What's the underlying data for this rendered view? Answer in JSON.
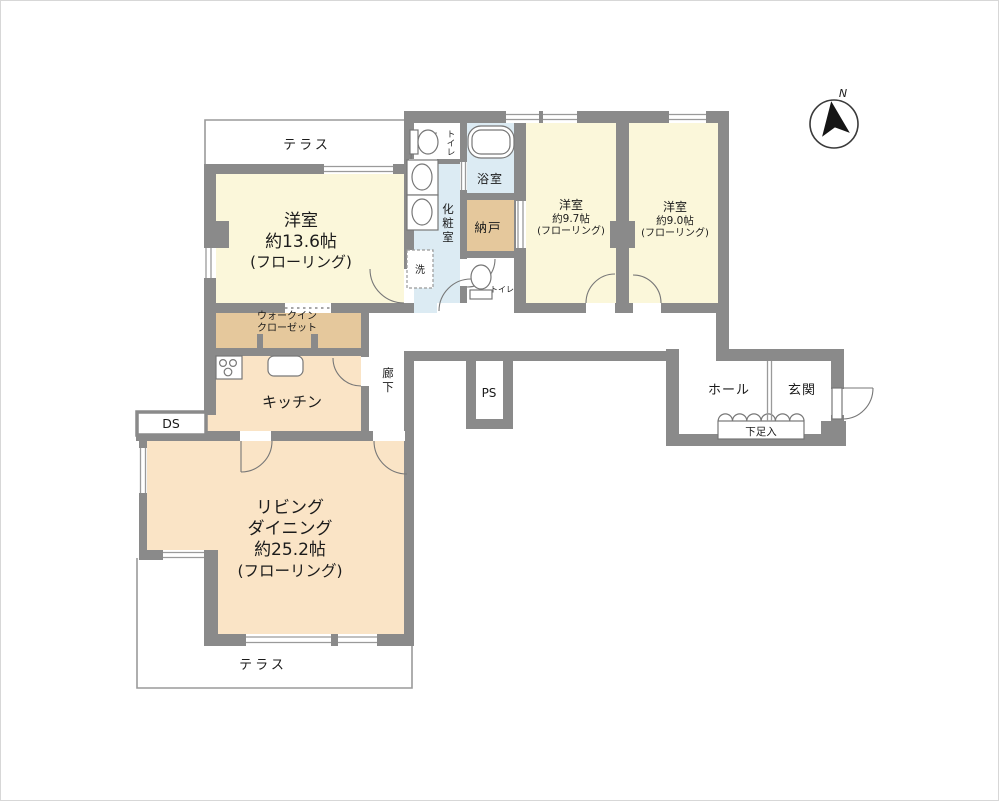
{
  "colors": {
    "wall": "#8a8a8a",
    "outline": "#9a9a9a",
    "fixture": "#777777",
    "text": "#1b1b1b",
    "room_yellow": "#fbf7da",
    "room_peach": "#fae4c6",
    "room_tan": "#e5c89c",
    "room_blue": "#dcebf3"
  },
  "compass": {
    "label": "N"
  },
  "rooms": {
    "terrace_top": {
      "label": "テラス"
    },
    "bedroom_a": {
      "lines": [
        "洋室",
        "約13.6帖",
        "(フローリング)"
      ]
    },
    "wic": {
      "lines": [
        "ウォークイン",
        "クローゼット"
      ]
    },
    "kitchen": {
      "label": "キッチン"
    },
    "ds": {
      "label": "DS"
    },
    "corridor": {
      "chars": [
        "廊",
        "下"
      ]
    },
    "ps": {
      "label": "PS"
    },
    "living": {
      "lines": [
        "リビング",
        "ダイニング",
        "約25.2帖",
        "(フローリング)"
      ]
    },
    "terrace_bottom": {
      "label": "テラス"
    },
    "toilet_upper": {
      "chars": [
        "ト",
        "イ",
        "レ"
      ]
    },
    "powder": {
      "chars": [
        "化",
        "粧",
        "室"
      ]
    },
    "bath": {
      "label": "浴室"
    },
    "storage": {
      "label": "納戸"
    },
    "laundry": {
      "label": "洗"
    },
    "toilet_lower": {
      "label": "トイレ"
    },
    "bedroom_b": {
      "lines": [
        "洋室",
        "約9.7帖",
        "(フローリング)"
      ]
    },
    "bedroom_c": {
      "lines": [
        "洋室",
        "約9.0帖",
        "(フローリング)"
      ]
    },
    "hall": {
      "label": "ホール"
    },
    "entrance": {
      "label": "玄関"
    },
    "shoe_cabinet": {
      "label": "下足入"
    }
  }
}
